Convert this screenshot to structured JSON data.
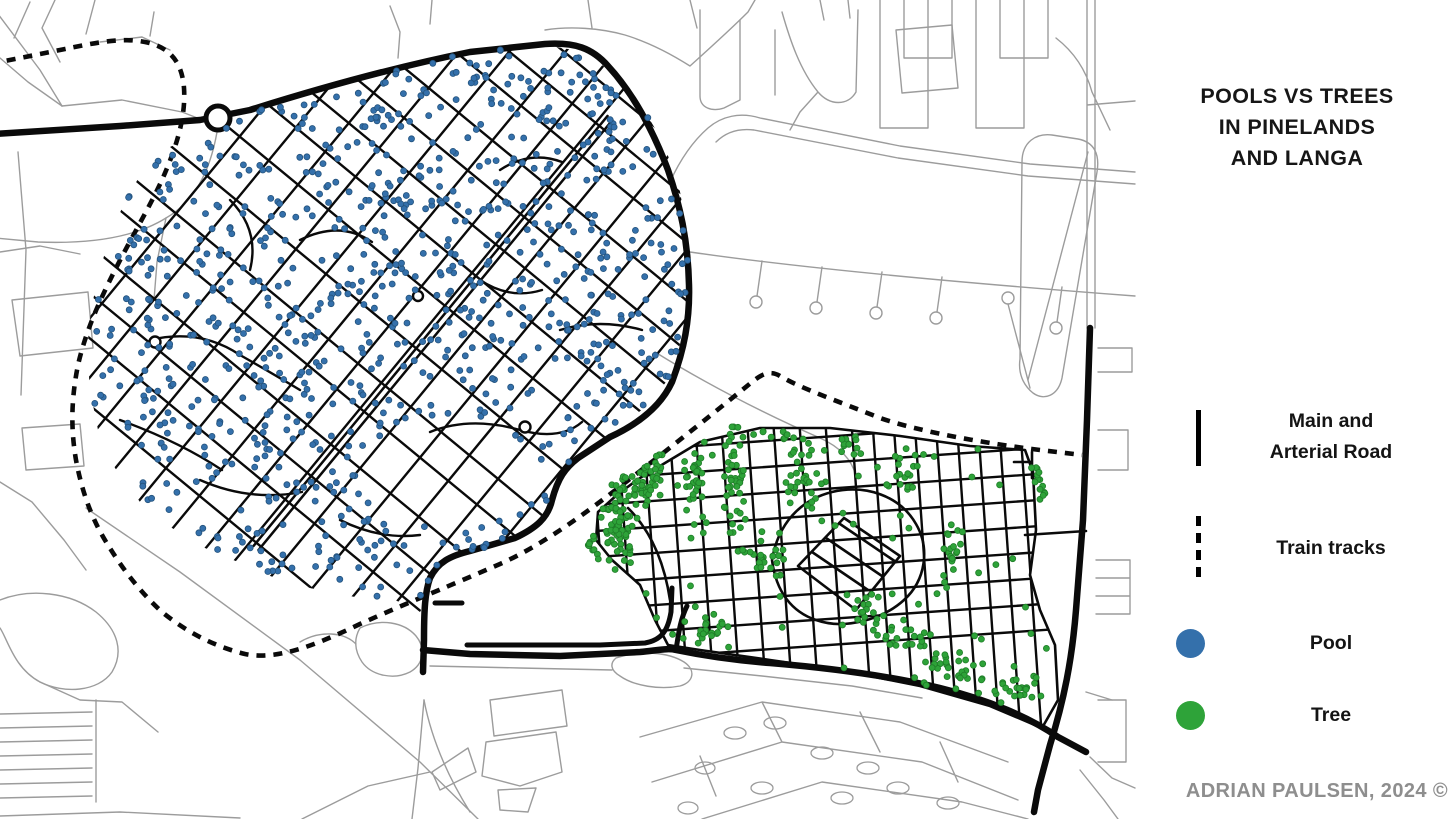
{
  "title": {
    "line1": "POOLS VS TREES",
    "line2": "IN PINELANDS",
    "line3": "AND LANGA"
  },
  "legend": {
    "items": [
      {
        "type": "solid-line",
        "label_line1": "Main and",
        "label_line2": "Arterial Road"
      },
      {
        "type": "dashed-line",
        "label": "Train tracks"
      },
      {
        "type": "dot",
        "label": "Pool",
        "color": "#3470AB"
      },
      {
        "type": "dot",
        "label": "Tree",
        "color": "#2EA339"
      }
    ]
  },
  "attribution": "ADRIAN PAULSEN, 2024 ©",
  "colors": {
    "pool": "#3470AB",
    "pool_edge": "#24537D",
    "tree": "#2EA339",
    "tree_edge": "#1F7D28",
    "street": "#0a0a0a",
    "context_road": "#9c9c9c",
    "background": "#ffffff"
  },
  "map": {
    "width": 1456,
    "height": 819,
    "gray_roads": [
      "M-5,10 L40,70 L62,106",
      "M30,2 L14,38",
      "M55,0 L42,28 L60,62",
      "M95,0 L86,34",
      "M62,106 L122,100 L182,112 L200,119",
      "M0,58 L28,82 L62,106",
      "M100,42 L142,37 L170,50",
      "M150,36 L154,12",
      "M217,132 C210,172 194,202 166,218 C134,238 88,244 38,242 L-5,238",
      "M166,218 L157,262 L154,300",
      "M18,152 L26,250 L21,395",
      "M12,300 L88,292 L93,348 L20,356 Z",
      "M22,428 L80,424 L84,466 L26,470 Z",
      "M0,252 L40,246 L80,254",
      "M0,482 L32,502 L64,540 L86,570",
      "M86,508 L180,572 L300,660 L420,762 L478,819",
      "M0,600 C30,588 70,592 96,612 C118,630 124,652 112,672 C98,692 64,694 40,682 C14,668 8,640 0,628",
      "M40,682 L80,700 L122,702 L158,732",
      "M96,700 L96,802",
      "M0,714 L92,712 M0,728 L92,726 M0,742 L92,740 M0,756 L92,754 M0,770 L92,768 M0,784 L92,782 M0,798 L92,796",
      "M0,816 L120,812 L240,818",
      "M412,819 L418,768 L424,700",
      "M424,700 C432,742 450,780 470,812",
      "M360,628 C380,618 404,622 416,636 C426,648 424,664 410,672 C394,680 372,676 362,662 C354,650 354,638 360,628 M300,642 C320,630 344,632 356,644",
      "M430,666 L520,668 L612,670 M616,658 C640,650 668,652 684,662 C696,670 694,682 680,686 C660,690 634,686 620,676 C610,670 610,663 616,658",
      "M684,668 L762,676 L852,686 L922,698",
      "M490,700 L562,690 L567,726 L494,736 Z M486,742 L556,732 L562,772 L520,786 L482,776 Z M498,790 L536,788 L528,812 L500,810 Z M432,772 L468,748 L476,772 L440,790 Z M302,819 L368,786 L430,772",
      "M640,737 L762,702 L900,722 L1008,762 M652,782 L782,742 L922,762 L1018,800 M702,819 L822,782 L962,802 L1028,819 M762,702 L782,742 M860,712 L880,752 M940,742 L958,782 M700,756 L716,796",
      "M1086,692 L1112,700 M1090,757 L1112,778 L1135,788",
      "M390,6 L400,32 L398,58 M432,0 L430,24",
      "M545,30 C570,26 600,28 625,35 C648,42 668,52 690,66 M592,28 L588,0 M690,66 C710,48 730,30 748,12 L755,0",
      "M760,118 L900,146 L1030,164 L1135,172 M754,130 L898,158 L1028,176 L1135,184 M760,118 C740,112 722,116 708,128 C692,142 680,160 670,182 M754,130 C738,128 726,132 716,142",
      "M700,10 L700,96 C700,108 712,112 724,108 L740,100 L740,20 M775,95 L775,30 M782,12 C790,40 800,70 818,92 C830,106 848,106 856,92 L858,10 M818,92 L800,112 L790,130 M896,30 L952,25 L958,88 L902,93 Z",
      "M880,0 L880,128 M904,0 L904,58 M928,0 L928,128 M952,0 L952,58 M976,0 L976,128 M1000,0 L1000,58 M1024,0 L1024,128 M1048,0 L1048,58 M904,58 L952,58 M1000,58 L1048,58 M880,128 L928,128 M976,128 L1024,128",
      "M1022,162 C1022,142 1036,133 1052,135 L1078,139 C1094,142 1100,154 1097,172 L1062,378 C1058,396 1044,401 1033,393 C1023,385 1018,373 1020,359 Z M1028,380 L1088,152",
      "M690,252 C800,268 950,282 1135,296 M762,261 L757,296 M822,267 L817,302 M882,272 L877,307 M942,277 L937,312 M1062,287 L1057,322 M1008,304 L1030,388",
      "M1087,0 L1087,328 M1095,0 L1095,328 M1087,105 L1135,101 M1056,38 C1074,52 1086,70 1092,92 L1110,130",
      "M1098,348 L1132,348 L1132,372 L1098,372 M1098,430 L1128,430 L1128,470 L1098,470 M1096,560 L1130,560 M1096,578 L1130,578 M1096,596 L1130,596 M1096,614 L1130,614 M1130,560 L1130,614 M1098,700 L1126,700 L1126,762 L1098,762 M1080,770 L1104,800 L1118,819",
      "M655,352 C700,380 760,412 820,438 C840,447 852,460 856,476",
      "M690,0 L697,28 M820,0 L824,20 M848,0 L850,18"
    ],
    "gray_ellipses": [
      [
        735,
        733,
        11,
        6
      ],
      [
        775,
        723,
        11,
        6
      ],
      [
        822,
        753,
        11,
        6
      ],
      [
        868,
        768,
        11,
        6
      ],
      [
        705,
        768,
        10,
        6
      ],
      [
        762,
        788,
        11,
        6
      ],
      [
        898,
        788,
        11,
        6
      ],
      [
        948,
        803,
        11,
        6
      ],
      [
        688,
        808,
        10,
        6
      ],
      [
        842,
        798,
        11,
        6
      ]
    ],
    "gray_circles": [
      [
        756,
        302,
        6
      ],
      [
        816,
        308,
        6
      ],
      [
        876,
        313,
        6
      ],
      [
        936,
        318,
        6
      ],
      [
        1056,
        328,
        6
      ],
      [
        1008,
        298,
        6
      ]
    ],
    "arterials": [
      "M-5,134 L120,126 L200,120 L250,110 C320,88 400,66 470,52 L545,44 C575,42 592,48 608,66 C632,92 652,128 668,170 C680,205 688,240 689,285 C690,320 684,350 672,382 C660,408 636,425 610,437 L578,458 C565,468 558,478 552,500 C548,518 536,528 515,538 L470,551 C450,556 438,562 430,578 C425,592 424,610 424,640 L423,672",
      "M423,650 L470,654 L560,656 L640,652 C660,650 668,648 676,650 C700,655 730,660 770,663 C830,668 890,676 940,688 C990,700 1030,718 1058,737 L1086,752",
      "M1090,328 L1087,420 L1083,520 L1076,610 C1072,660 1064,700 1050,745 L1038,790 L1034,812"
    ],
    "arterial_stubs": [
      "M467,645 L600,645 L645,643 C662,640 668,630 671,612 L672,588",
      "M676,650 C679,630 681,618 687,606",
      "M435,603 L462,603"
    ],
    "train_tracks": [
      "M-10,64 L60,50 C95,43 120,37 145,42 C170,47 182,62 184,88 C186,118 176,148 162,180 C148,210 130,240 114,272 C100,300 86,330 78,365 C72,395 70,425 76,460 C82,492 92,520 108,545 C122,568 140,592 162,612 C184,630 212,646 245,654 C275,660 310,648 360,624 C400,606 440,590 500,564 C545,544 590,510 635,475 C675,444 720,408 752,382 C762,374 770,370 780,376 C800,388 840,402 880,418 C920,432 990,444 1040,450 L1082,455"
    ],
    "roundabout": [
      218,
      118,
      12
    ],
    "junction_circles": [
      [
        155,
        342,
        5.5
      ],
      [
        525,
        427,
        5.5
      ],
      [
        418,
        296,
        5
      ]
    ],
    "pinelands": {
      "polygon": [
        [
          215,
          125
        ],
        [
          300,
          97
        ],
        [
          390,
          69
        ],
        [
          470,
          52
        ],
        [
          545,
          45
        ],
        [
          585,
          52
        ],
        [
          615,
          75
        ],
        [
          640,
          103
        ],
        [
          663,
          142
        ],
        [
          679,
          186
        ],
        [
          688,
          237
        ],
        [
          690,
          290
        ],
        [
          683,
          336
        ],
        [
          667,
          381
        ],
        [
          643,
          409
        ],
        [
          610,
          433
        ],
        [
          577,
          459
        ],
        [
          559,
          480
        ],
        [
          549,
          513
        ],
        [
          521,
          535
        ],
        [
          488,
          548
        ],
        [
          454,
          555
        ],
        [
          432,
          575
        ],
        [
          427,
          600
        ],
        [
          420,
          612
        ],
        [
          395,
          600
        ],
        [
          360,
          598
        ],
        [
          330,
          592
        ],
        [
          295,
          585
        ],
        [
          262,
          573
        ],
        [
          238,
          562
        ],
        [
          205,
          548
        ],
        [
          172,
          528
        ],
        [
          140,
          502
        ],
        [
          115,
          468
        ],
        [
          98,
          430
        ],
        [
          90,
          390
        ],
        [
          87,
          350
        ],
        [
          91,
          310
        ],
        [
          99,
          272
        ],
        [
          110,
          237
        ],
        [
          124,
          203
        ],
        [
          142,
          172
        ],
        [
          170,
          147
        ]
      ],
      "avenue": {
        "p1": [
          256,
          548
        ],
        "p2": [
          610,
          118
        ],
        "offset": 3.2
      },
      "grid": {
        "center": [
          430,
          330
        ],
        "half_len": 430,
        "family1": {
          "angle": -50.5,
          "start": -270,
          "end": 310,
          "min_gap": 29,
          "max_gap": 46,
          "seed": 11
        },
        "family2": {
          "angle": 39.5,
          "start": -300,
          "end": 330,
          "min_gap": 33,
          "max_gap": 52,
          "seed": 23
        }
      },
      "extra_streets": [
        "M150,340 Q200,328 240,355 Q270,372 300,390",
        "M120,420 Q180,442 222,470",
        "M500,170 Q530,150 562,162",
        "M300,240 Q340,220 372,242",
        "M430,432 Q470,416 520,430 Q560,441 582,422",
        "M200,480 Q250,502 302,492",
        "M560,330 Q600,318 642,330",
        "M480,280 Q510,300 542,290",
        "M230,200 Q260,230 250,270",
        "M340,520 Q380,540 420,535"
      ],
      "park_exclusion": [
        450,
        475,
        92,
        52
      ],
      "pool_dots": {
        "n": 900,
        "seed": 5,
        "r": 3
      }
    },
    "langa": {
      "polygon": [
        [
          640,
          478
        ],
        [
          700,
          442
        ],
        [
          760,
          428
        ],
        [
          830,
          428
        ],
        [
          900,
          436
        ],
        [
          970,
          446
        ],
        [
          1025,
          450
        ],
        [
          1033,
          472
        ],
        [
          1036,
          530
        ],
        [
          1030,
          575
        ],
        [
          1040,
          610
        ],
        [
          1055,
          645
        ],
        [
          1058,
          700
        ],
        [
          1042,
          728
        ],
        [
          990,
          706
        ],
        [
          920,
          686
        ],
        [
          840,
          670
        ],
        [
          770,
          660
        ],
        [
          700,
          650
        ],
        [
          668,
          645
        ],
        [
          655,
          620
        ],
        [
          640,
          585
        ],
        [
          612,
          560
        ],
        [
          596,
          540
        ],
        [
          598,
          512
        ],
        [
          618,
          494
        ]
      ],
      "grid": {
        "rot": -4,
        "center": [
          840,
          545
        ],
        "xs": [
          600,
          626,
          652,
          678,
          704,
          730,
          756,
          782,
          808,
          834,
          860,
          881,
          902,
          923,
          944,
          965,
          986,
          1007,
          1028,
          1049
        ],
        "ys": [
          436,
          462,
          488,
          514,
          540,
          566,
          592,
          618,
          644
        ],
        "y_span": [
          418,
          770
        ],
        "x_span": [
          575,
          1095
        ]
      },
      "extra_streets": [
        "M772,560 C778,524 800,500 832,492 C866,484 900,496 916,524 C930,548 926,580 904,600 C882,620 844,630 816,620 C792,612 776,592 772,560 Z",
        "M798,566 L844,518 L900,556 L856,610 Z",
        "M812,552 L868,590",
        "M826,538 L882,576",
        "M840,524 L896,562",
        "M670,600 C664,560 650,530 628,508",
        "M1025,535 L1086,531",
        "M1032,452 L1032,478 M1014,462 L1032,462"
      ],
      "tree_clusters": [
        [
          618,
          520,
          20,
          75,
          80
        ],
        [
          650,
          470,
          18,
          40,
          35
        ],
        [
          698,
          495,
          16,
          55,
          35
        ],
        [
          735,
          478,
          12,
          75,
          45
        ],
        [
          762,
          555,
          30,
          25,
          25
        ],
        [
          800,
          478,
          20,
          45,
          28
        ],
        [
          852,
          448,
          25,
          15,
          12
        ],
        [
          905,
          468,
          20,
          30,
          18
        ],
        [
          948,
          558,
          14,
          35,
          18
        ],
        [
          895,
          638,
          35,
          18,
          22
        ],
        [
          955,
          668,
          35,
          18,
          28
        ],
        [
          1015,
          688,
          30,
          15,
          22
        ],
        [
          1040,
          480,
          12,
          25,
          14
        ],
        [
          868,
          608,
          25,
          18,
          16
        ],
        [
          700,
          630,
          30,
          18,
          20
        ],
        [
          640,
          445,
          25,
          12,
          14
        ],
        [
          775,
          435,
          30,
          10,
          10
        ],
        [
          592,
          558,
          8,
          28,
          10
        ]
      ],
      "tree_uniform": {
        "n": 60,
        "seed": 9
      },
      "tree_r": 3,
      "accept_scale": 1.06
    }
  }
}
